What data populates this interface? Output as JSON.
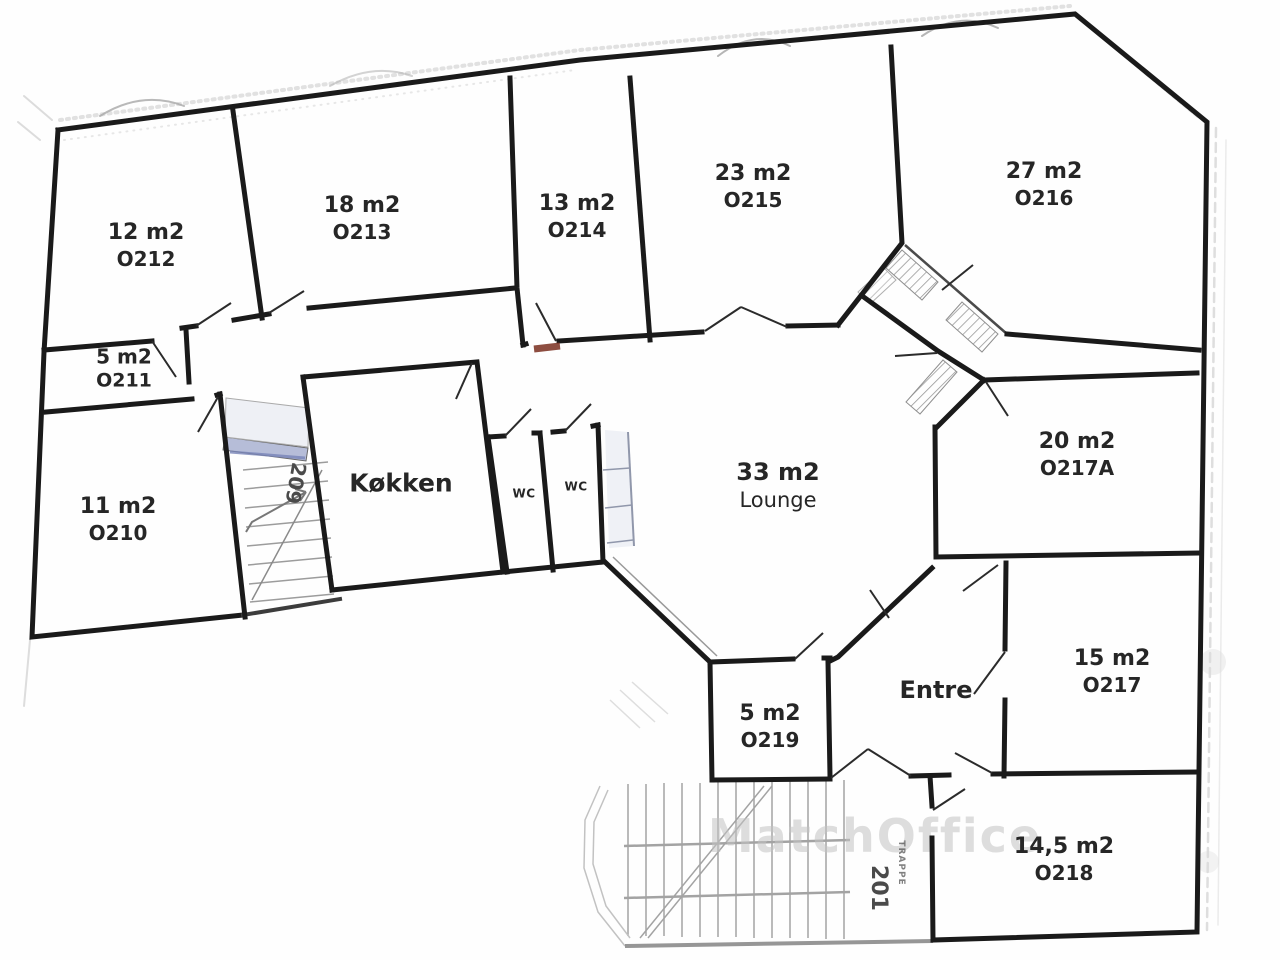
{
  "floorplan": {
    "rooms": {
      "o210": {
        "area": "11 m2",
        "code": "O210"
      },
      "o211": {
        "area": "5 m2",
        "code": "O211"
      },
      "o212": {
        "area": "12 m2",
        "code": "O212"
      },
      "o213": {
        "area": "18 m2",
        "code": "O213"
      },
      "o214": {
        "area": "13 m2",
        "code": "O214"
      },
      "o215": {
        "area": "23 m2",
        "code": "O215"
      },
      "o216": {
        "area": "27 m2",
        "code": "O216"
      },
      "o217": {
        "area": "15 m2",
        "code": "O217"
      },
      "o217a": {
        "area": "20 m2",
        "code": "O217A"
      },
      "o218": {
        "area": "14,5 m2",
        "code": "O218"
      },
      "o219": {
        "area": "5 m2",
        "code": "O219"
      },
      "lounge": {
        "area": "33 m2",
        "name": "Lounge"
      },
      "kitchen": {
        "name": "Køkken"
      },
      "wc_left": {
        "name": "WC"
      },
      "wc_right": {
        "name": "WC"
      },
      "entre": {
        "name": "Entre"
      }
    },
    "stairwells": {
      "upper": {
        "label": "209"
      },
      "lower": {
        "label": "201",
        "sublabel": "TRAPPE"
      }
    },
    "watermark": {
      "text": "MatchOffice"
    },
    "colors": {
      "wall": "#1a1a1a",
      "glazing": "#b6bdd8",
      "red_mark": "#7a2f20",
      "scan_gray": "#bbbbbb"
    }
  }
}
